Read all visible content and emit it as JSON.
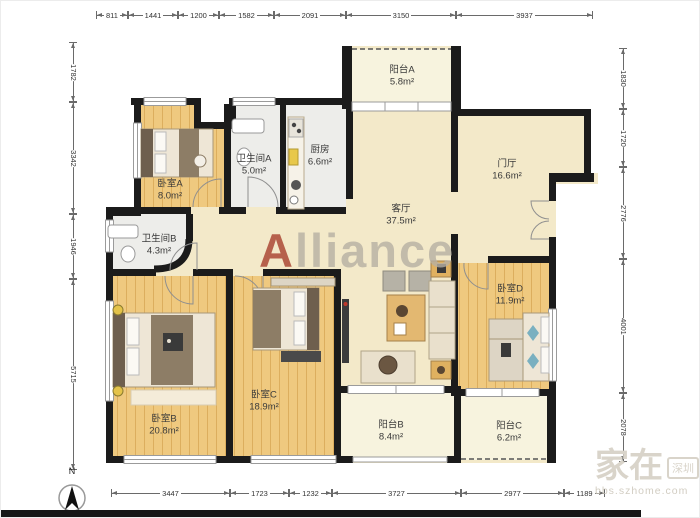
{
  "plan": {
    "rooms": [
      {
        "id": "balcony-a",
        "name": "阳台A",
        "area": "5.8m²"
      },
      {
        "id": "bath-a",
        "name": "卫生间A",
        "area": "5.0m²"
      },
      {
        "id": "kitchen",
        "name": "厨房",
        "area": "6.6m²"
      },
      {
        "id": "hall",
        "name": "门厅",
        "area": "16.6m²"
      },
      {
        "id": "living",
        "name": "客厅",
        "area": "37.5m²"
      },
      {
        "id": "bedroom-a",
        "name": "卧室A",
        "area": "8.0m²"
      },
      {
        "id": "bath-b",
        "name": "卫生间B",
        "area": "4.3m²"
      },
      {
        "id": "bedroom-b",
        "name": "卧室B",
        "area": "20.8m²"
      },
      {
        "id": "bedroom-c",
        "name": "卧室C",
        "area": "18.9m²"
      },
      {
        "id": "bedroom-d",
        "name": "卧室D",
        "area": "11.9m²"
      },
      {
        "id": "balcony-b",
        "name": "阳台B",
        "area": "8.4m²"
      },
      {
        "id": "balcony-c",
        "name": "阳台C",
        "area": "6.2m²"
      }
    ],
    "dims": {
      "top": [
        "811",
        "1441",
        "1200",
        "1582",
        "2091",
        "3150",
        "3937"
      ],
      "left": [
        "1782",
        "3342",
        "1946",
        "5715"
      ],
      "right": [
        "1830",
        "1720",
        "2776",
        "4001",
        "2078"
      ],
      "bottom": [
        "3447",
        "1723",
        "1232",
        "3727",
        "2977",
        "1189"
      ]
    },
    "compass": {
      "label": "N"
    },
    "watermark": {
      "center": "Alliance",
      "corner_main": "家在",
      "corner_badge": "深圳",
      "corner_sub": "bbs.szhome.com"
    },
    "colors": {
      "wall": "#1b1b1b",
      "wood_floor": "#efc97f",
      "living_beige": "#f3e9c9",
      "wet_room_gray": "#ededea",
      "balcony_cream": "#f7f3de",
      "watermark_red": "#a8402e"
    }
  }
}
